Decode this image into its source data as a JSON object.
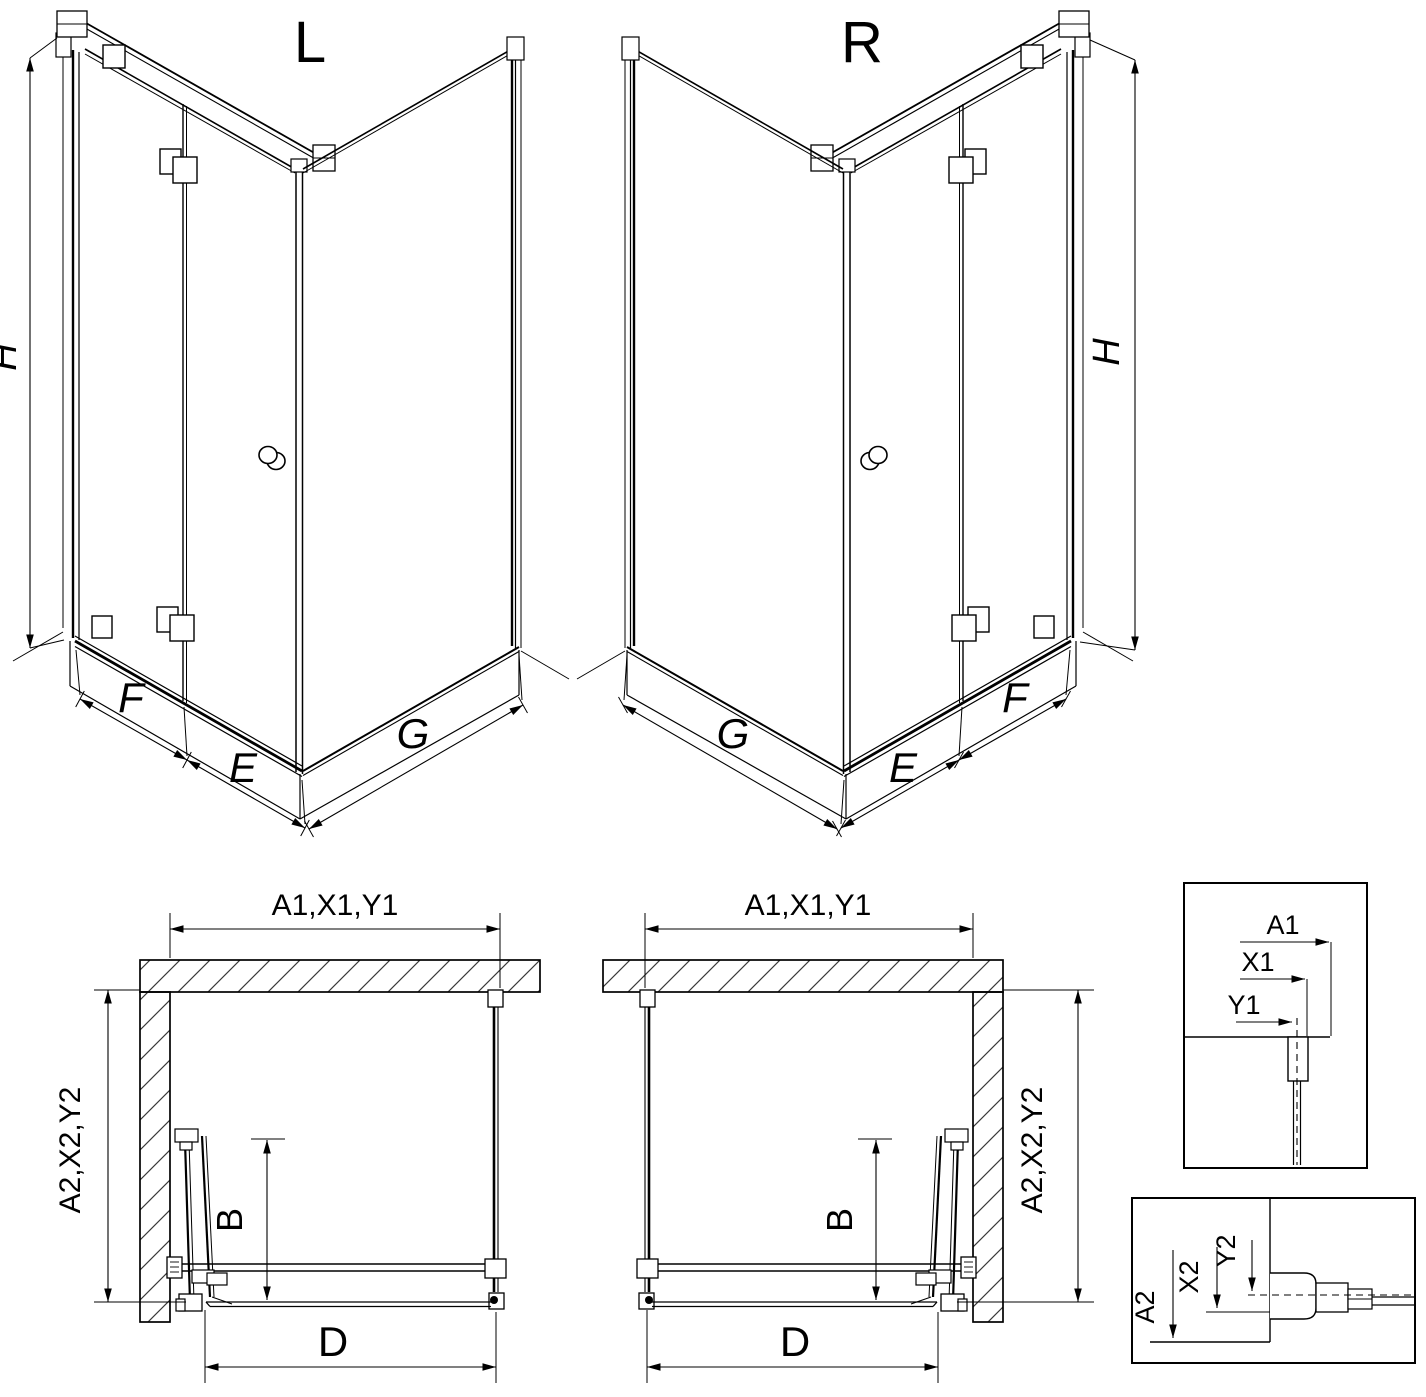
{
  "drawing": {
    "background": "#ffffff",
    "line_color": "#000000",
    "hatch_color": "#3a3a3a",
    "views": {
      "iso_left": {
        "title": "L",
        "dim_height": "H",
        "dim_door_fixed": "F",
        "dim_door_swing": "E",
        "dim_side_wall": "G"
      },
      "iso_right": {
        "title": "R",
        "dim_height": "H",
        "dim_door_fixed": "F",
        "dim_door_swing": "E",
        "dim_side_wall": "G"
      },
      "plan_left": {
        "dim_width": "A1,X1,Y1",
        "dim_depth": "A2,X2,Y2",
        "dim_door": "B",
        "dim_opening": "D"
      },
      "plan_right": {
        "dim_width": "A1,X1,Y1",
        "dim_depth": "A2,X2,Y2",
        "dim_door": "B",
        "dim_opening": "D"
      },
      "detail_width": {
        "dim_outer": "A1",
        "dim_mid": "X1",
        "dim_inner": "Y1"
      },
      "detail_depth": {
        "dim_outer": "A2",
        "dim_mid": "X2",
        "dim_inner": "Y2"
      }
    }
  }
}
